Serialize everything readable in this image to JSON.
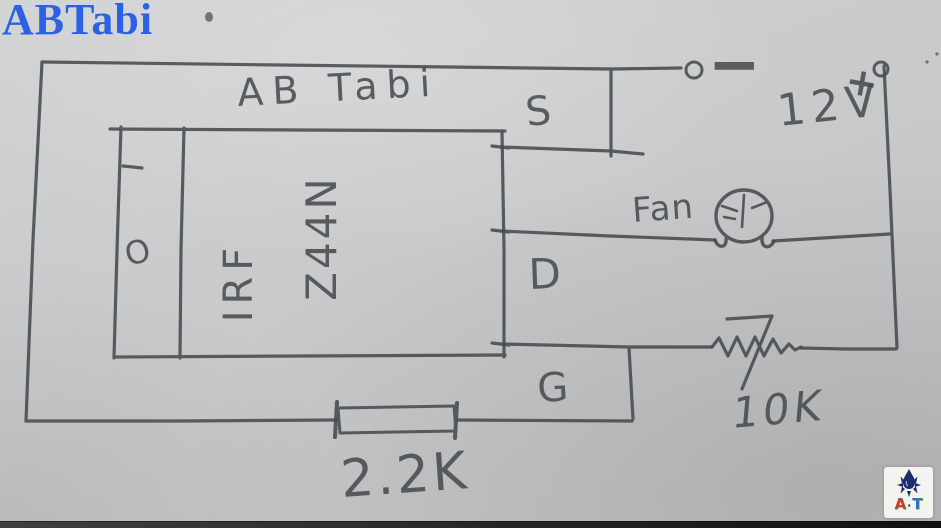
{
  "watermark": {
    "text": "ABTabi"
  },
  "drawing": {
    "title": "AB Tabi",
    "mosfet": {
      "part_line1": "IRF",
      "part_line2": "Z44N",
      "mount_hole": "O"
    },
    "pins": {
      "source": "S",
      "drain": "D",
      "gate": "G"
    },
    "supply": {
      "voltage": "12V",
      "plus": "+",
      "minus": "−"
    },
    "fan": {
      "label": "Fan"
    },
    "resistors": {
      "drain_gate": "10K",
      "gate_series": "2.2K"
    }
  },
  "logo": {
    "letter_a": "A",
    "dot": "·",
    "letter_t": "T"
  },
  "colors": {
    "paper": "#c8cacb",
    "pencil": "#474a50",
    "watermark_blue": "#2b62e4",
    "logo_red": "#d03a2b",
    "logo_blue": "#2f6fc9",
    "logo_navy": "#1d2e6e",
    "logo_green": "#3fae49"
  }
}
